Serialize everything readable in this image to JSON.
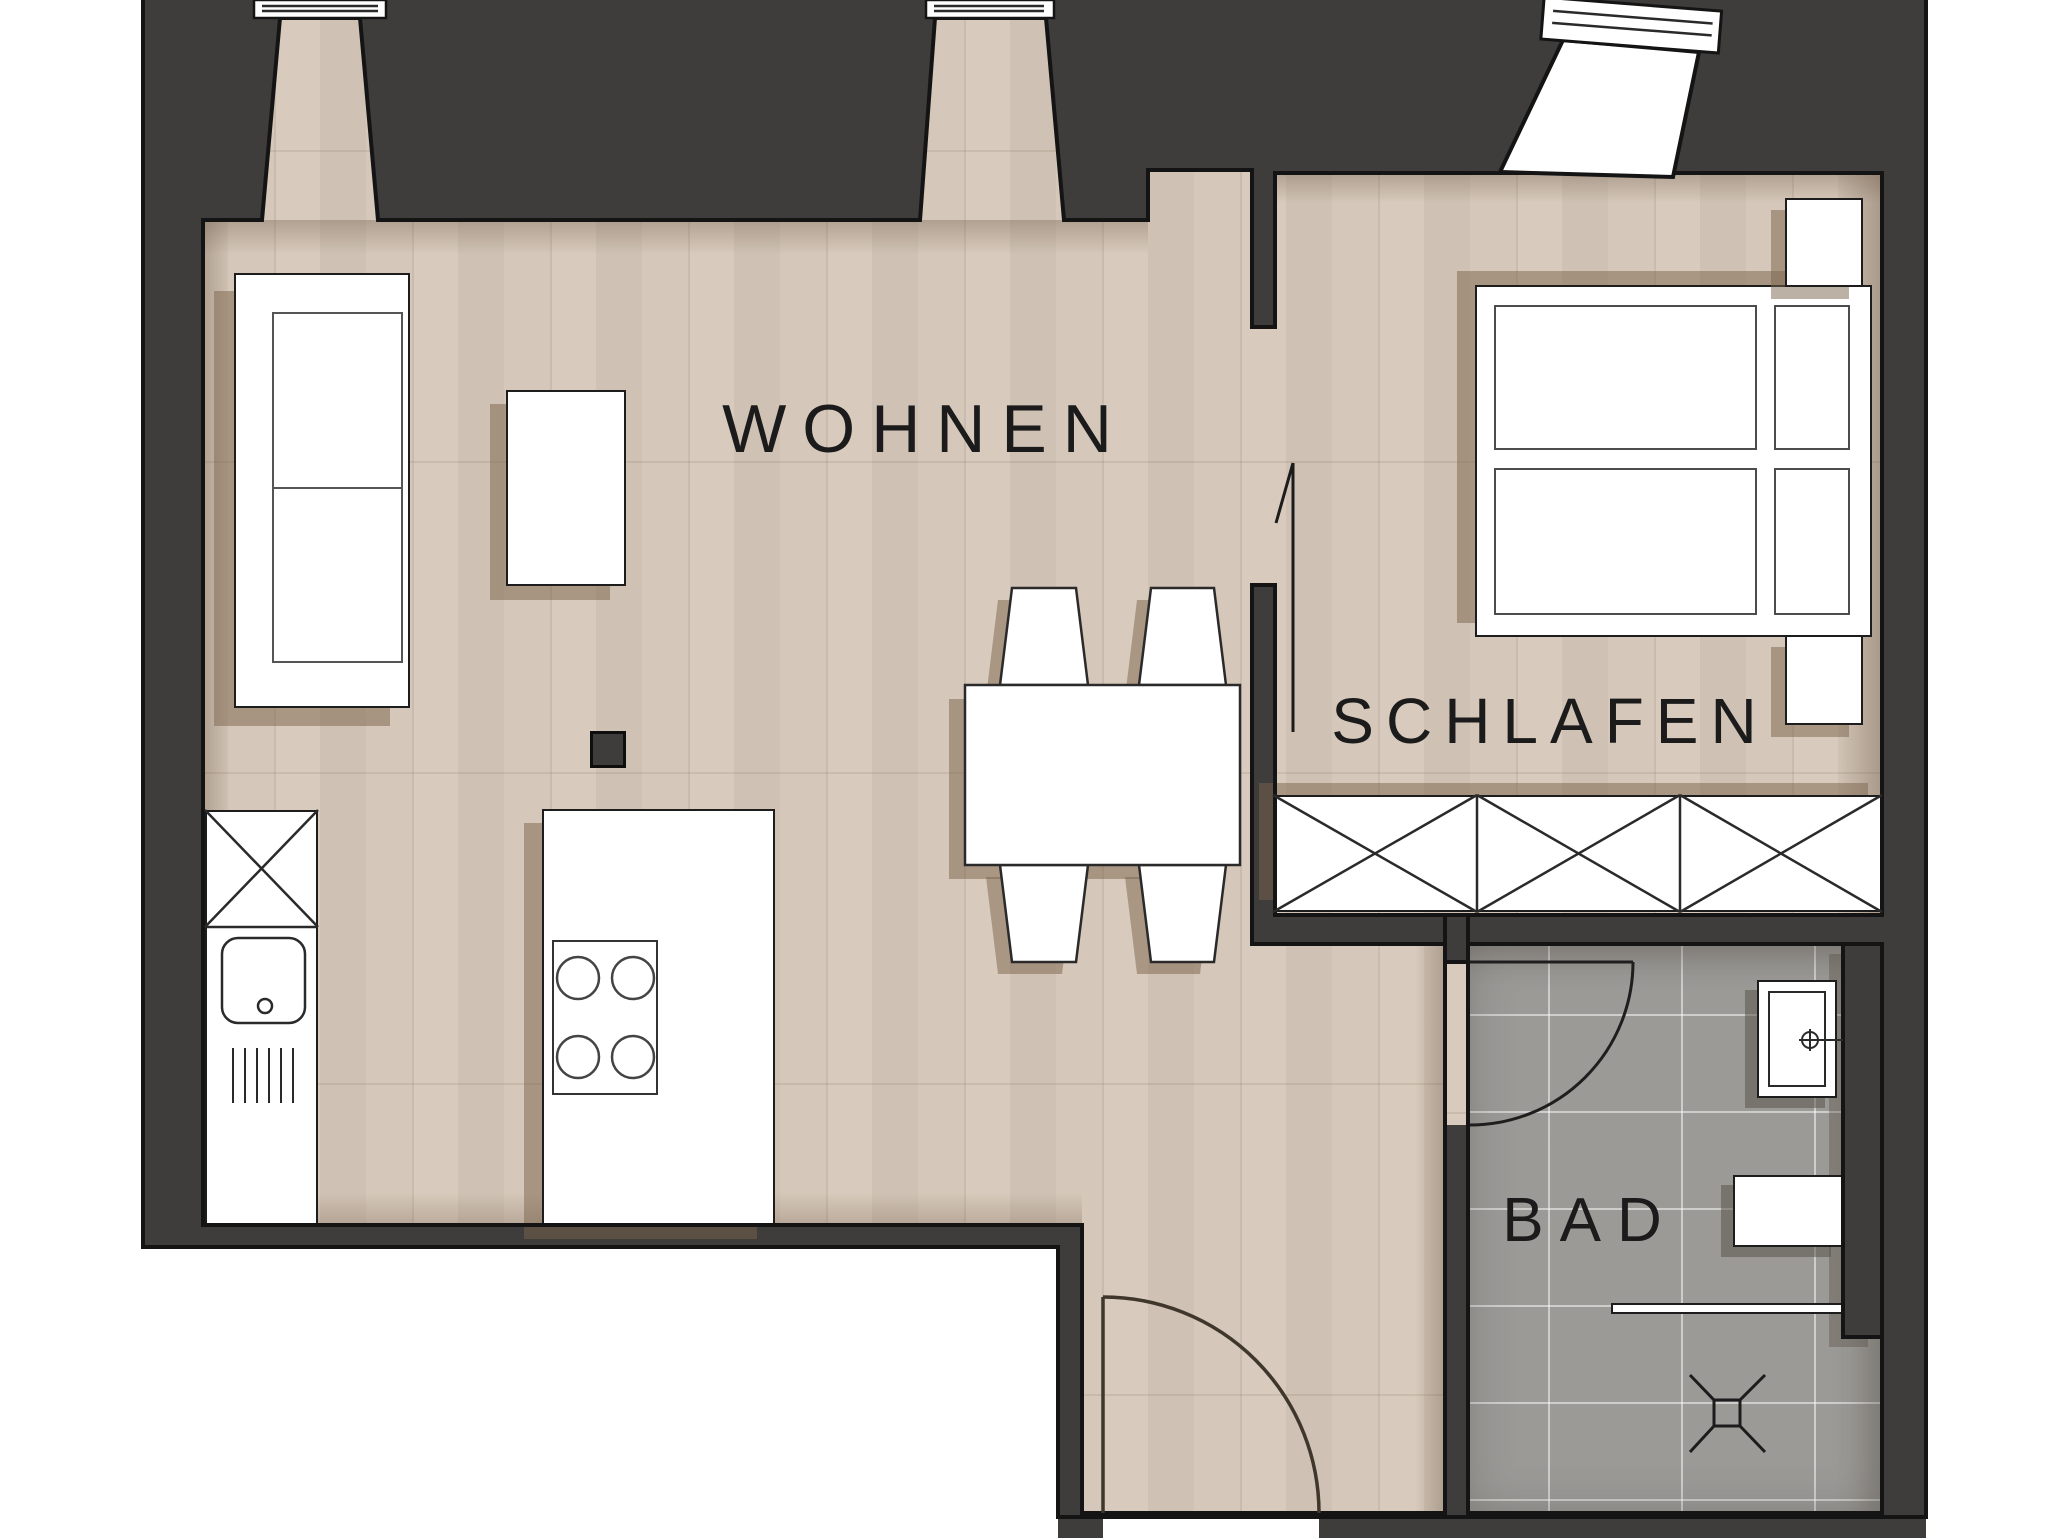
{
  "page_title": "Grundriss Wohnung",
  "rooms": {
    "living": {
      "label": "WOHNEN"
    },
    "bedroom": {
      "label": "SCHLAFEN"
    },
    "bath": {
      "label": "BAD"
    }
  },
  "icons": {
    "door_swing": "quarter-circle-door-swing",
    "floor_drain": "x-cross-drain",
    "wardrobe_x": "crossed-panel",
    "window": "triple-line-window-symbol"
  },
  "colors": {
    "wall": "#3e3d3c",
    "outline": "#141414",
    "wood_floor": "#d5c7b9",
    "tile_floor": "#9b9a97",
    "furniture_fill": "#ffffff",
    "shadow": "rgba(122,99,76,0.5)",
    "door_line": "#3f362c"
  }
}
